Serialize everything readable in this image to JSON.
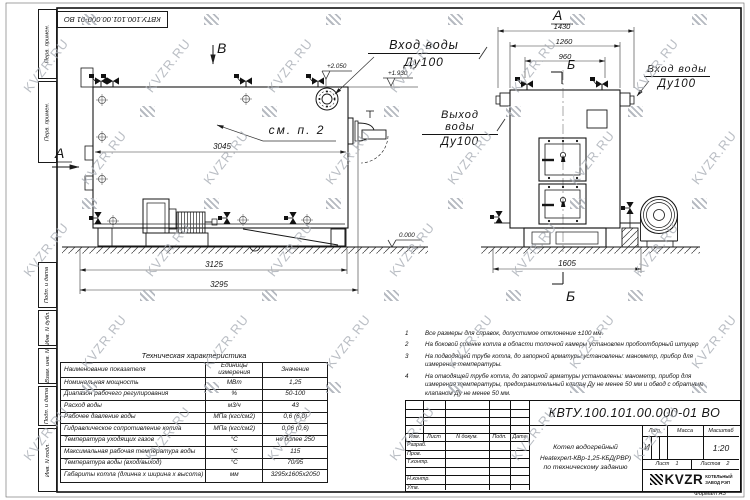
{
  "sheet": {
    "doc_number": "КВТУ.100.101.00.000-01 ВО",
    "format_label": "Формат  А3",
    "watermark": "KVZR.RU"
  },
  "margin_fields": {
    "top": [
      "Перв. примен.",
      "Перв. примен."
    ],
    "bottom": [
      "Подп. и дата",
      "Инв. N дубл.",
      "Взам. инв. N",
      "Подп. и дата",
      "Инв. N подл."
    ]
  },
  "side_view": {
    "view_letter_b": "В",
    "section_letter_a": "А",
    "see_note": "см. п. 2",
    "dim_3045": "3045",
    "dim_3125": "3125",
    "dim_3295": "3295",
    "elev_plus2050": "+2.050",
    "elev_plus1930": "+1.930",
    "elev_zero": "0.000",
    "inlet_label": "Вход воды",
    "inlet_dn": "Ду100",
    "outlet_label": "Выход воды",
    "outlet_dn": "Ду100"
  },
  "front_view": {
    "view_letter_a": "А",
    "section_letter_b_top": "Б",
    "section_letter_b_bottom": "Б",
    "dim_1430": "1430",
    "dim_1260": "1260",
    "dim_960": "960",
    "dim_1605": "1605",
    "inlet_label": "Вход воды",
    "inlet_dn": "Ду100"
  },
  "notes": [
    {
      "num": "1",
      "text": "Все размеры для справок, допустимое отклонение  ±100 мм."
    },
    {
      "num": "2",
      "text": "На боковой стенке котла в области топочной камеры установлен пробоотборный штуцер"
    },
    {
      "num": "3",
      "text": "На  подводящей трубе котла, до запорной арматуры установлены: манометр, прибор для измерения температуры."
    },
    {
      "num": "4",
      "text": "На отводящей трубе котла, до запорной арматуры установлены: манометр, прибор для измерения температуры, предохранительный клапан Ду не менее 50 мм и обвод с обратным клапаном Ду не менее 50 мм."
    }
  ],
  "tech_table": {
    "title": "Техническая характеристика",
    "headers": [
      "Наименование показателя",
      "Единицы измерения",
      "Значение"
    ],
    "rows": [
      [
        "Номинальная мощность",
        "МВт",
        "1,25"
      ],
      [
        "Диапазон рабочего регулирования",
        "%",
        "50-100"
      ],
      [
        "Расход воды",
        "м3/ч",
        "43"
      ],
      [
        "Рабочее давление воды",
        "МПа (кгс/см2)",
        "0,6 (6,0)"
      ],
      [
        "Гидравлическое сопротивление котла",
        "МПа (кгс/см2)",
        "0,06 (0,6)"
      ],
      [
        "Температура уходящих газов",
        "°С",
        "не более 250"
      ],
      [
        "Максимальная рабочая температура воды",
        "°С",
        "115"
      ],
      [
        "Температура воды (вход/выход)",
        "°С",
        "70/95"
      ],
      [
        "Габариты котла (длинна х ширина х высота)",
        "мм",
        "3295х1605х2050"
      ]
    ]
  },
  "title_block": {
    "doc_number": "КВТУ.100.101.00.000-01 ВО",
    "name_line1": "Котел водогрейный",
    "name_line2": "Heatexpert-КВр-1,25-КБД(РВР)",
    "name_line3": "по техническому заданию",
    "col_izm": "Изм.",
    "col_list": "Лист",
    "col_doc": "N докум.",
    "col_podp": "Подп.",
    "col_data": "Дата",
    "row_razrab": "Разраб.",
    "row_prov": "Пров.",
    "row_tkontr": "Т.контр.",
    "row_nkontr": "Н.контр.",
    "row_utv": "Утв.",
    "lit_header": "Лит.",
    "mass_header": "Масса",
    "scale_header": "Масштаб",
    "lit_value": "И",
    "scale_value": "1:20",
    "sheet_label": "Лист",
    "sheet_value": "1",
    "sheets_label": "Листов",
    "sheets_value": "2",
    "logo_text": "KVZR",
    "logo_sub1": "КОТЕЛЬНЫЙ",
    "logo_sub2": "ЗАВОД РЭП"
  }
}
